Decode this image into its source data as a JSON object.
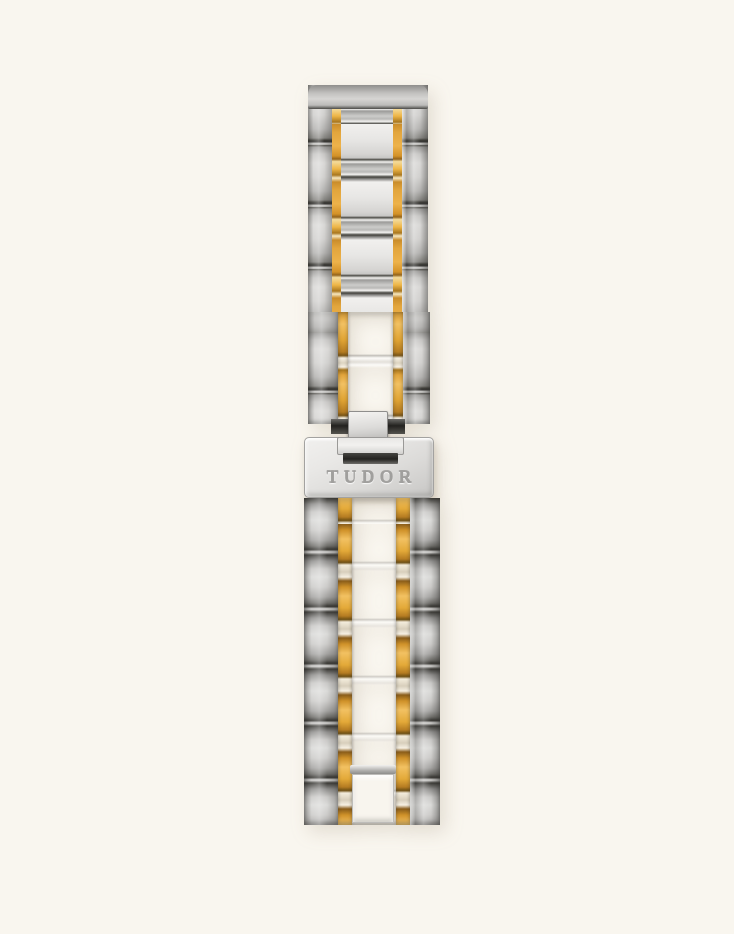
{
  "product": {
    "brand_engraving": "TUDOR",
    "alt": "Two-tone brushed steel and yellow-gold watch bracelet fastened with a TUDOR-engraved folding clasp, photographed vertically on a cream background"
  },
  "colors": {
    "background": "#f9f6ef",
    "steel_highlight": "#eceae7",
    "steel_mid": "#c7c6c4",
    "steel_shadow": "#3a3936",
    "gold_highlight": "#f2c162",
    "gold_mid": "#dd9d35",
    "gold_shadow": "#8a5d1a",
    "clasp_face": "#e9e8e6",
    "engraving_text": "#a09f9d"
  }
}
